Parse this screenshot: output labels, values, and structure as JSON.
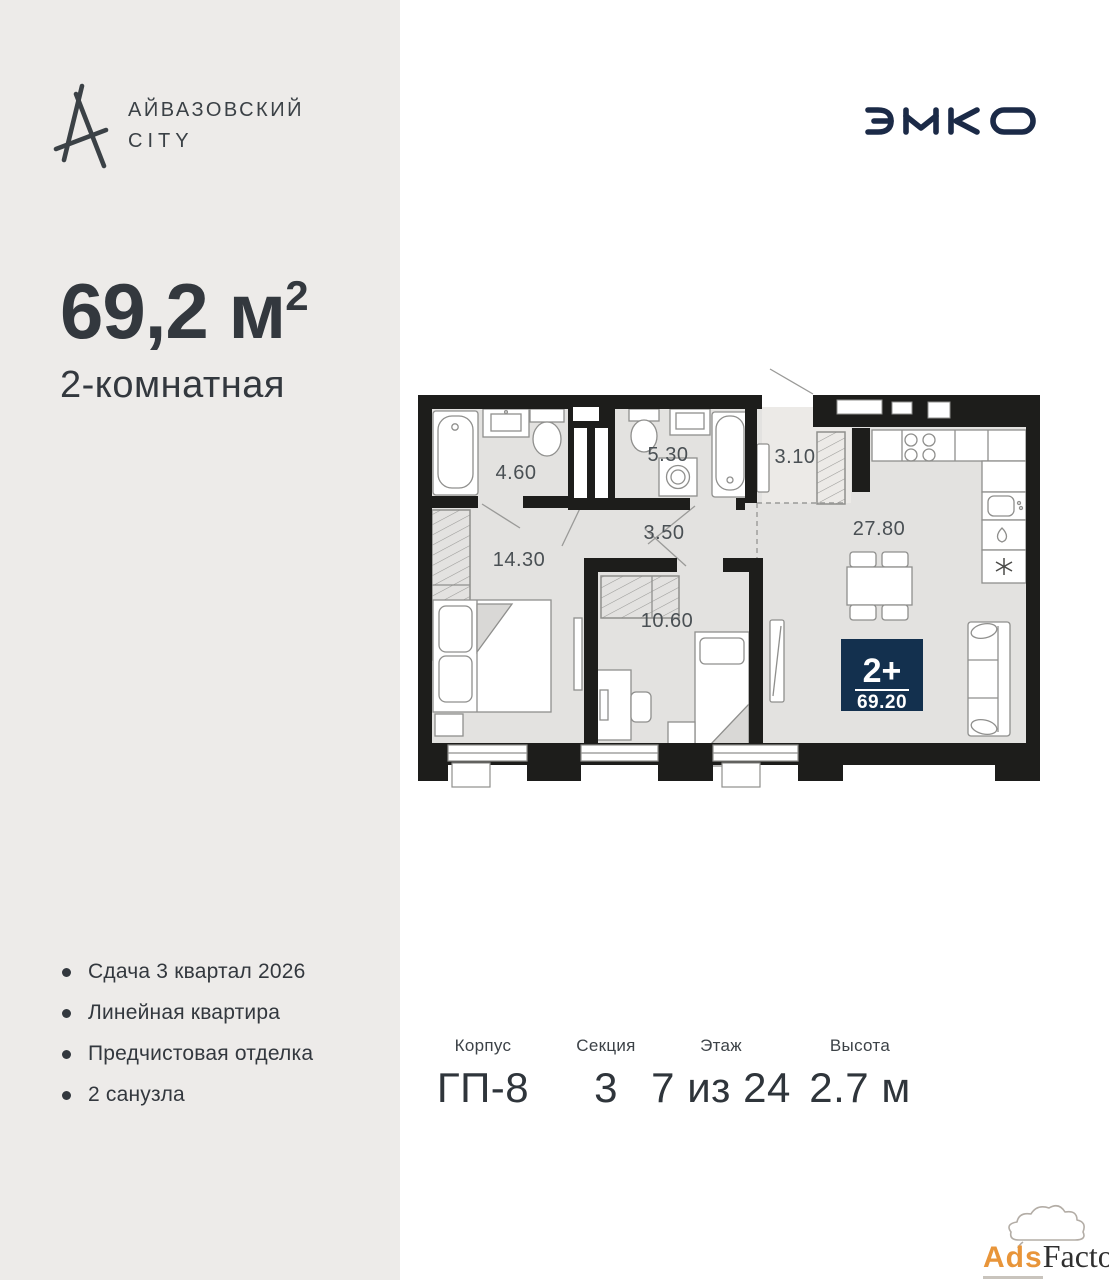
{
  "brand": {
    "line1": "АЙВАЗОВСКИЙ",
    "line2": "CITY"
  },
  "developer": {
    "name": "ЭНКО"
  },
  "apartment": {
    "area_main": "69,2 м",
    "area_sup": "2",
    "type_label": "2-комнатная"
  },
  "features": [
    "Сдача 3 квартал 2026",
    "Линейная квартира",
    "Предчистовая отделка",
    "2 санузла"
  ],
  "floorplan": {
    "badge": {
      "rooms": "2+",
      "area": "69.20"
    },
    "labels": {
      "bath1": "4.60",
      "bath2": "5.30",
      "hall": "3.10",
      "corridor": "3.50",
      "bedroom": "14.30",
      "kids_room": "10.60",
      "kitchen_living": "27.80"
    }
  },
  "details": [
    {
      "label": "Корпус",
      "value": "ГП-8"
    },
    {
      "label": "Секция",
      "value": "3"
    },
    {
      "label": "Этаж",
      "value": "7 из 24"
    },
    {
      "label": "Высота",
      "value": "2.7 м"
    }
  ],
  "watermark": {
    "ads": "Ads",
    "factory": "Factory"
  },
  "colors": {
    "left_panel": "#edebe9",
    "wall": "#1d1d1b",
    "room_fill": "#e3e2e0",
    "hall_fill": "#eceae7",
    "badge_navy": "#13304e",
    "logo_navy": "#1b2a47",
    "accent_orange": "#e8953a",
    "text_dark": "#33383e"
  }
}
